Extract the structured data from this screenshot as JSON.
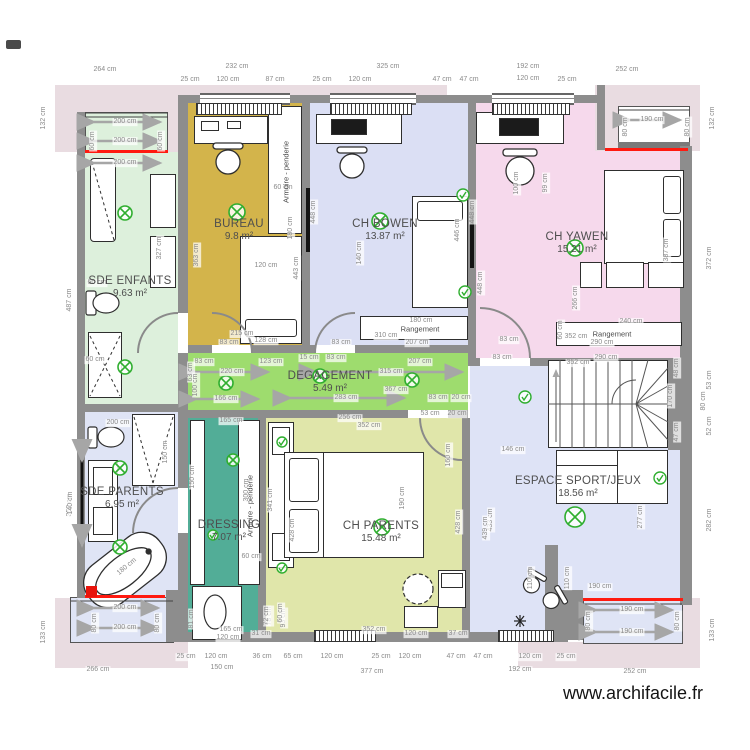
{
  "watermark": "www.archifacile.fr",
  "colors": {
    "wall": "#8d8d8d",
    "terrace": "#e9dce1",
    "window_red": "#ff1a10",
    "symbol_green": "#2fae2f",
    "bay_blue": "#dfe4f5"
  },
  "rooms": [
    {
      "id": "sde-enfants",
      "name": "SDE ENFANTS",
      "area": "9.63 m²",
      "color": "#ddf0dc",
      "label_x": 130,
      "label_y": 287
    },
    {
      "id": "bureau",
      "name": "BUREAU",
      "area": "9.8 m²",
      "color": "#d3b44b",
      "label_x": 239,
      "label_y": 230
    },
    {
      "id": "ch-bowen",
      "name": "CH BOWEN",
      "area": "13.87 m²",
      "color": "#dbdff4",
      "label_x": 385,
      "label_y": 230
    },
    {
      "id": "ch-yawen",
      "name": "CH YAWEN",
      "area": "15.21 m²",
      "color": "#f6d9ec",
      "label_x": 577,
      "label_y": 243
    },
    {
      "id": "degagement",
      "name": "DEGAGEMENT",
      "area": "5.49 m²",
      "color": "#9edc6e",
      "label_x": 330,
      "label_y": 382
    },
    {
      "id": "sde-parents",
      "name": "SDE PARENTS",
      "area": "6.95 m²",
      "color": "#dfe4f5",
      "label_x": 122,
      "label_y": 498
    },
    {
      "id": "dressing",
      "name": "DRESSING",
      "area": "7.07 m²",
      "color": "#52ad97",
      "label_x": 229,
      "label_y": 531
    },
    {
      "id": "ch-parents",
      "name": "CH PARENTS",
      "area": "15.48 m²",
      "color": "#e0e6aa",
      "label_x": 381,
      "label_y": 532
    },
    {
      "id": "espace-sport",
      "name": "ESPACE SPORT/JEUX",
      "area": "18.56 m²",
      "color": "#dee3f6",
      "label_x": 578,
      "label_y": 487
    }
  ],
  "furniture_labels": [
    {
      "t": "Armoire - penderie",
      "x": 286,
      "y": 172
    },
    {
      "t": "Armoire - penderie",
      "x": 250,
      "y": 506
    },
    {
      "t": "Rangement",
      "x": 420,
      "y": 329,
      "h": 1
    },
    {
      "t": "Rangement",
      "x": 612,
      "y": 334,
      "h": 1
    }
  ],
  "dimensions": [
    {
      "t": "264 cm",
      "x": 105,
      "y": 70
    },
    {
      "t": "232 cm",
      "x": 237,
      "y": 67
    },
    {
      "t": "325 cm",
      "x": 388,
      "y": 67
    },
    {
      "t": "192 cm",
      "x": 528,
      "y": 67
    },
    {
      "t": "252 cm",
      "x": 627,
      "y": 70
    },
    {
      "t": "25 cm",
      "x": 190,
      "y": 80
    },
    {
      "t": "120 cm",
      "x": 228,
      "y": 80
    },
    {
      "t": "87 cm",
      "x": 275,
      "y": 80
    },
    {
      "t": "25 cm",
      "x": 322,
      "y": 80
    },
    {
      "t": "120 cm",
      "x": 360,
      "y": 80
    },
    {
      "t": "47 cm",
      "x": 442,
      "y": 80
    },
    {
      "t": "47 cm",
      "x": 469,
      "y": 80
    },
    {
      "t": "120 cm",
      "x": 528,
      "y": 79
    },
    {
      "t": "25 cm",
      "x": 567,
      "y": 80
    },
    {
      "t": "200 cm",
      "x": 125,
      "y": 122
    },
    {
      "t": "200 cm",
      "x": 125,
      "y": 141
    },
    {
      "t": "200 cm",
      "x": 125,
      "y": 163
    },
    {
      "t": "60 cm",
      "x": 93,
      "y": 141,
      "v": 1
    },
    {
      "t": "60 cm",
      "x": 161,
      "y": 141,
      "v": 1
    },
    {
      "t": "190 cm",
      "x": 652,
      "y": 120
    },
    {
      "t": "80 cm",
      "x": 626,
      "y": 127,
      "v": 1
    },
    {
      "t": "80 cm",
      "x": 688,
      "y": 127,
      "v": 1
    },
    {
      "t": "132 cm",
      "x": 44,
      "y": 118,
      "v": 1
    },
    {
      "t": "487 cm",
      "x": 70,
      "y": 300,
      "v": 1
    },
    {
      "t": "352 cm",
      "x": 70,
      "y": 505,
      "v": 1
    },
    {
      "t": "133 cm",
      "x": 44,
      "y": 632,
      "v": 1
    },
    {
      "t": "132 cm",
      "x": 713,
      "y": 118,
      "v": 1
    },
    {
      "t": "372 cm",
      "x": 710,
      "y": 258,
      "v": 1
    },
    {
      "t": "53 cm",
      "x": 710,
      "y": 380,
      "v": 1
    },
    {
      "t": "80 cm",
      "x": 704,
      "y": 401,
      "v": 1
    },
    {
      "t": "52 cm",
      "x": 710,
      "y": 426,
      "v": 1
    },
    {
      "t": "282 cm",
      "x": 710,
      "y": 520,
      "v": 1
    },
    {
      "t": "133 cm",
      "x": 713,
      "y": 630,
      "v": 1
    },
    {
      "t": "363 cm",
      "x": 197,
      "y": 255,
      "v": 1
    },
    {
      "t": "448 cm",
      "x": 314,
      "y": 212,
      "v": 1
    },
    {
      "t": "443 cm",
      "x": 297,
      "y": 268,
      "v": 1
    },
    {
      "t": "180 cm",
      "x": 291,
      "y": 228,
      "v": 1
    },
    {
      "t": "60 cm",
      "x": 283,
      "y": 188
    },
    {
      "t": "120 cm",
      "x": 266,
      "y": 266
    },
    {
      "t": "215 cm",
      "x": 242,
      "y": 334
    },
    {
      "t": "128 cm",
      "x": 266,
      "y": 341
    },
    {
      "t": "140 cm",
      "x": 360,
      "y": 253,
      "v": 1
    },
    {
      "t": "446 cm",
      "x": 458,
      "y": 230,
      "v": 1
    },
    {
      "t": "448 cm",
      "x": 473,
      "y": 212,
      "v": 1
    },
    {
      "t": "180 cm",
      "x": 421,
      "y": 321
    },
    {
      "t": "310 cm",
      "x": 386,
      "y": 336
    },
    {
      "t": "207 cm",
      "x": 417,
      "y": 343
    },
    {
      "t": "83 cm",
      "x": 229,
      "y": 343
    },
    {
      "t": "83 cm",
      "x": 341,
      "y": 343
    },
    {
      "t": "83 cm",
      "x": 204,
      "y": 362
    },
    {
      "t": "123 cm",
      "x": 271,
      "y": 362
    },
    {
      "t": "220 cm",
      "x": 232,
      "y": 372
    },
    {
      "t": "15 cm",
      "x": 309,
      "y": 358
    },
    {
      "t": "83 cm",
      "x": 336,
      "y": 358
    },
    {
      "t": "315 cm",
      "x": 391,
      "y": 372
    },
    {
      "t": "207 cm",
      "x": 420,
      "y": 362
    },
    {
      "t": "166 cm",
      "x": 226,
      "y": 399
    },
    {
      "t": "283 cm",
      "x": 346,
      "y": 398
    },
    {
      "t": "367 cm",
      "x": 396,
      "y": 390
    },
    {
      "t": "83 cm",
      "x": 438,
      "y": 398
    },
    {
      "t": "20 cm",
      "x": 461,
      "y": 398
    },
    {
      "t": "63 cm",
      "x": 191,
      "y": 372,
      "v": 1
    },
    {
      "t": "100 cm",
      "x": 196,
      "y": 385,
      "v": 1
    },
    {
      "t": "256 cm",
      "x": 350,
      "y": 418
    },
    {
      "t": "352 cm",
      "x": 369,
      "y": 426
    },
    {
      "t": "53 cm",
      "x": 430,
      "y": 414
    },
    {
      "t": "20 cm",
      "x": 457,
      "y": 414
    },
    {
      "t": "100 cm",
      "x": 517,
      "y": 183,
      "v": 1
    },
    {
      "t": "99 cm",
      "x": 546,
      "y": 183,
      "v": 1
    },
    {
      "t": "448 cm",
      "x": 481,
      "y": 283,
      "v": 1
    },
    {
      "t": "266 cm",
      "x": 576,
      "y": 298,
      "v": 1
    },
    {
      "t": "387 cm",
      "x": 667,
      "y": 250,
      "v": 1
    },
    {
      "t": "240 cm",
      "x": 631,
      "y": 322
    },
    {
      "t": "352 cm",
      "x": 576,
      "y": 337
    },
    {
      "t": "290 cm",
      "x": 602,
      "y": 343
    },
    {
      "t": "60 cm",
      "x": 561,
      "y": 330,
      "v": 1
    },
    {
      "t": "83 cm",
      "x": 509,
      "y": 340
    },
    {
      "t": "83 cm",
      "x": 502,
      "y": 358
    },
    {
      "t": "146 cm",
      "x": 513,
      "y": 450
    },
    {
      "t": "433 cm",
      "x": 491,
      "y": 520,
      "v": 1
    },
    {
      "t": "277 cm",
      "x": 641,
      "y": 517,
      "v": 1
    },
    {
      "t": "110 cm",
      "x": 531,
      "y": 578,
      "v": 1
    },
    {
      "t": "110 cm",
      "x": 568,
      "y": 578,
      "v": 1
    },
    {
      "t": "190 cm",
      "x": 600,
      "y": 587
    },
    {
      "t": "352 cm",
      "x": 578,
      "y": 363
    },
    {
      "t": "290 cm",
      "x": 606,
      "y": 358
    },
    {
      "t": "48 cm",
      "x": 677,
      "y": 368,
      "v": 1
    },
    {
      "t": "47 cm",
      "x": 677,
      "y": 432,
      "v": 1
    },
    {
      "t": "170 cm",
      "x": 671,
      "y": 396,
      "v": 1
    },
    {
      "t": "439 cm",
      "x": 486,
      "y": 528,
      "v": 1
    },
    {
      "t": "190 cm",
      "x": 632,
      "y": 610
    },
    {
      "t": "190 cm",
      "x": 632,
      "y": 632
    },
    {
      "t": "80 cm",
      "x": 589,
      "y": 621,
      "v": 1
    },
    {
      "t": "80 cm",
      "x": 678,
      "y": 621,
      "v": 1
    },
    {
      "t": "341 cm",
      "x": 271,
      "y": 500,
      "v": 1
    },
    {
      "t": "428 cm",
      "x": 293,
      "y": 530,
      "v": 1
    },
    {
      "t": "428 cm",
      "x": 459,
      "y": 522,
      "v": 1
    },
    {
      "t": "190 cm",
      "x": 403,
      "y": 498,
      "v": 1
    },
    {
      "t": "160 cm",
      "x": 449,
      "y": 455,
      "v": 1
    },
    {
      "t": "120 cm",
      "x": 416,
      "y": 634
    },
    {
      "t": "37 cm",
      "x": 458,
      "y": 634
    },
    {
      "t": "31 cm",
      "x": 261,
      "y": 634
    },
    {
      "t": "93 cm",
      "x": 284,
      "y": 618,
      "v": 1
    },
    {
      "t": "78 cm",
      "x": 270,
      "y": 616,
      "v": 1
    },
    {
      "t": "352 cm",
      "x": 374,
      "y": 630
    },
    {
      "t": "200 cm",
      "x": 118,
      "y": 423
    },
    {
      "t": "150 cm",
      "x": 166,
      "y": 452,
      "v": 1
    },
    {
      "t": "140 cm",
      "x": 71,
      "y": 503,
      "v": 1
    },
    {
      "t": "180 cm",
      "x": 127,
      "y": 567,
      "r": "-40deg"
    },
    {
      "t": "200 cm",
      "x": 125,
      "y": 608
    },
    {
      "t": "200 cm",
      "x": 125,
      "y": 628
    },
    {
      "t": "80 cm",
      "x": 95,
      "y": 623,
      "v": 1
    },
    {
      "t": "80 cm",
      "x": 158,
      "y": 623,
      "v": 1
    },
    {
      "t": "165 cm",
      "x": 231,
      "y": 421
    },
    {
      "t": "150 cm",
      "x": 193,
      "y": 477,
      "v": 1
    },
    {
      "t": "300 cm",
      "x": 247,
      "y": 490,
      "v": 1
    },
    {
      "t": "60 cm",
      "x": 251,
      "y": 557
    },
    {
      "t": "165 cm",
      "x": 231,
      "y": 630
    },
    {
      "t": "120 cm",
      "x": 228,
      "y": 638
    },
    {
      "t": "72 cm",
      "x": 267,
      "y": 616,
      "v": 1
    },
    {
      "t": "60 cm",
      "x": 281,
      "y": 613,
      "v": 1
    },
    {
      "t": "81 cm",
      "x": 192,
      "y": 619,
      "v": 1
    },
    {
      "t": "60 cm",
      "x": 97,
      "y": 283
    },
    {
      "t": "60 cm",
      "x": 95,
      "y": 360
    },
    {
      "t": "327 cm",
      "x": 160,
      "y": 248,
      "v": 1
    },
    {
      "t": "25 cm",
      "x": 186,
      "y": 657
    },
    {
      "t": "120 cm",
      "x": 216,
      "y": 657
    },
    {
      "t": "36 cm",
      "x": 262,
      "y": 657
    },
    {
      "t": "65 cm",
      "x": 293,
      "y": 657
    },
    {
      "t": "120 cm",
      "x": 332,
      "y": 657
    },
    {
      "t": "25 cm",
      "x": 381,
      "y": 657
    },
    {
      "t": "120 cm",
      "x": 410,
      "y": 657
    },
    {
      "t": "47 cm",
      "x": 456,
      "y": 657
    },
    {
      "t": "47 cm",
      "x": 483,
      "y": 657
    },
    {
      "t": "120 cm",
      "x": 530,
      "y": 657
    },
    {
      "t": "25 cm",
      "x": 566,
      "y": 657
    },
    {
      "t": "266 cm",
      "x": 98,
      "y": 670
    },
    {
      "t": "150 cm",
      "x": 222,
      "y": 668
    },
    {
      "t": "377 cm",
      "x": 372,
      "y": 672
    },
    {
      "t": "192 cm",
      "x": 520,
      "y": 670
    },
    {
      "t": "252 cm",
      "x": 635,
      "y": 672
    }
  ]
}
